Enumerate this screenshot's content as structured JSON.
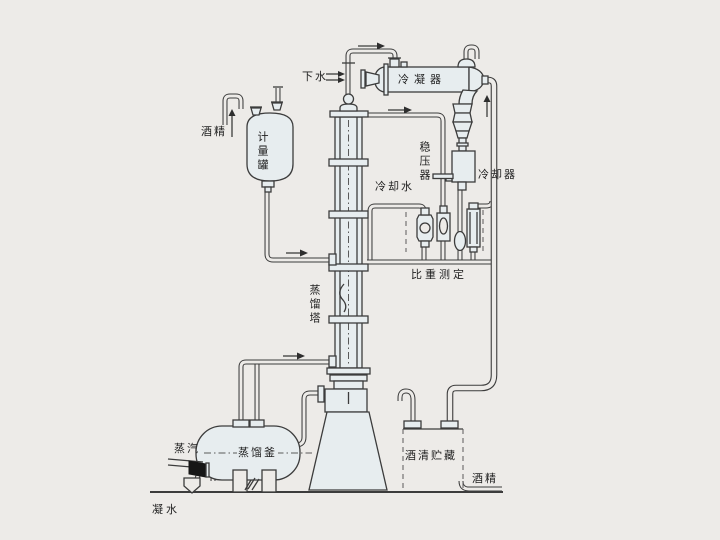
{
  "diagram": {
    "type": "alcohol-distillation-process-flow-diagram",
    "labels": {
      "drain_water": "下水",
      "condenser": "冷凝器",
      "alcohol_feed": "酒精",
      "metering_tank": "计量罐",
      "pressure_stabilizer": "稳压器",
      "cooling_water": "冷却水",
      "cooler": "冷却器",
      "specific_gravity_measurement": "比重测定",
      "distillation_column": "蒸馏塔",
      "steam": "蒸汽",
      "distillation_kettle": "蒸馏釜",
      "alcohol_storage": "酒清贮藏",
      "alcohol_out": "酒精",
      "condensate_water": "凝水"
    },
    "colors": {
      "background": "#edebe8",
      "line": "#3c3c3c",
      "vessel_fill": "#e7edef",
      "valve_fill": "#161616",
      "text": "#1f1f1f"
    }
  }
}
